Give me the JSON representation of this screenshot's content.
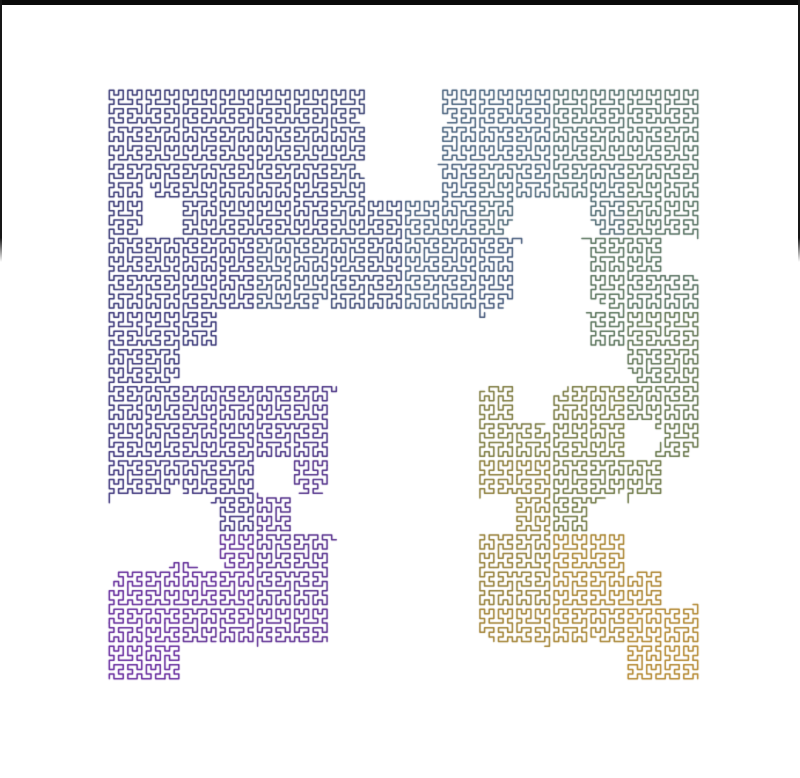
{
  "canvas": {
    "width": 800,
    "height": 778,
    "background": "#ffffff"
  },
  "frame": {
    "top_bar": {
      "height": 5,
      "color": "#0a0a0a"
    },
    "side_lines": {
      "width": 2,
      "color": "#161616",
      "y_start": 0,
      "y_end": 262,
      "fade_px": 24
    }
  },
  "curve": {
    "type": "hilbert-space-filling-curve",
    "order": 7,
    "cells_per_side": 128,
    "traversal": {
      "start": "bottom-left",
      "end": "bottom-right",
      "quadrant_order": [
        "bottom-left",
        "top-left",
        "top-right",
        "bottom-right"
      ]
    },
    "square": {
      "left": 107,
      "top": 88,
      "size": 593
    },
    "line_width": 1.5,
    "grid_blocks": 16,
    "occupancy": [
      "1111111001111111",
      "1111111001111111",
      "1111111001111111",
      "1011111111100111",
      "1111111111100110",
      "1111111111100111",
      "1110000000000111",
      "1100000000000011",
      "1111110000101111",
      "1111110000111101",
      "1111010000111110",
      "0001100000011000",
      "0001110000111100",
      "1111110000111110",
      "1111110000111111",
      "1100000000000011"
    ],
    "gap_jitter": {
      "seed": 7,
      "amplitude_cells": 6
    },
    "gradient": [
      {
        "t": 0.0,
        "color": "#60229b"
      },
      {
        "t": 0.06,
        "color": "#58268f"
      },
      {
        "t": 0.13,
        "color": "#4e2a87"
      },
      {
        "t": 0.2,
        "color": "#3c2d7c"
      },
      {
        "t": 0.27,
        "color": "#323073"
      },
      {
        "t": 0.38,
        "color": "#33366f"
      },
      {
        "t": 0.46,
        "color": "#394872"
      },
      {
        "t": 0.53,
        "color": "#3f5377"
      },
      {
        "t": 0.6,
        "color": "#45607b"
      },
      {
        "t": 0.66,
        "color": "#506c63"
      },
      {
        "t": 0.72,
        "color": "#557058"
      },
      {
        "t": 0.78,
        "color": "#697440"
      },
      {
        "t": 0.84,
        "color": "#7f7838"
      },
      {
        "t": 0.9,
        "color": "#967b2e"
      },
      {
        "t": 1.0,
        "color": "#b28428"
      }
    ]
  }
}
